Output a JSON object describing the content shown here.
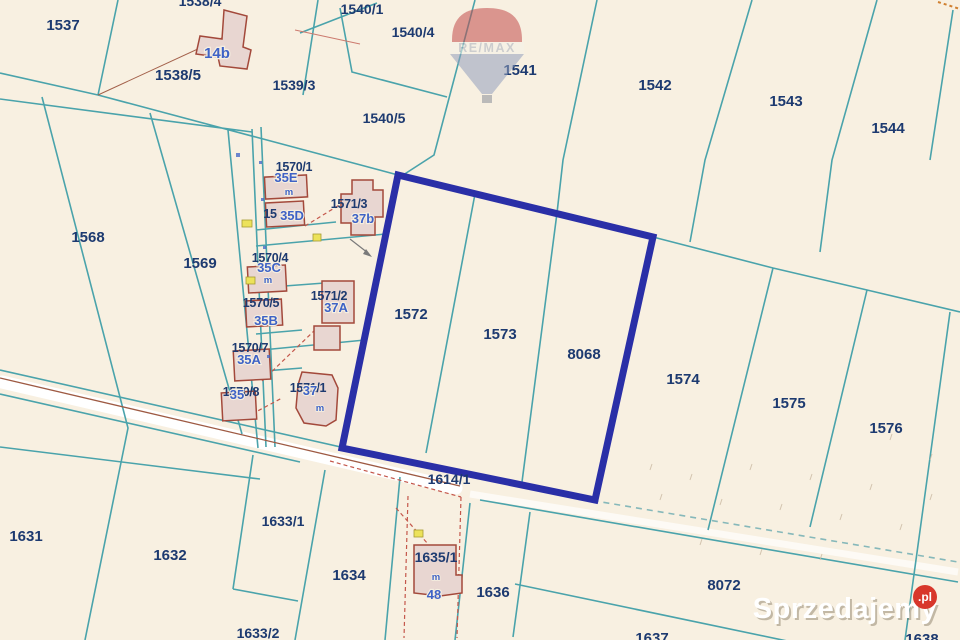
{
  "map": {
    "parcel_labels": {
      "p1537": "1537",
      "p1538_4": "1538/4",
      "p1538_5": "1538/5",
      "p1539_3": "1539/3",
      "p1540_1": "1540/1",
      "p1540_4": "1540/4",
      "p1540_5": "1540/5",
      "p1541": "1541",
      "p1542": "1542",
      "p1543": "1543",
      "p1544": "1544",
      "p1568": "1568",
      "p1569": "1569",
      "p1570_1": "1570/1",
      "p1570_3_prefix": "15",
      "p1570_4": "1570/4",
      "p1570_5": "1570/5",
      "p1570_7": "1570/7",
      "p1570_8": "1570/8",
      "p1571_1": "1571/1",
      "p1571_2": "1571/2",
      "p1571_3": "1571/3",
      "p1572": "1572",
      "p1573": "1573",
      "p8068": "8068",
      "p1574": "1574",
      "p1575": "1575",
      "p1576": "1576",
      "p1614_1": "1614/1",
      "p1631": "1631",
      "p1632": "1632",
      "p1633_1": "1633/1",
      "p1633_2": "1633/2",
      "p1634": "1634",
      "p1635_1": "1635/1",
      "p1636": "1636",
      "p1637": "1637",
      "p8072": "8072",
      "p1638": "1638"
    },
    "building_labels": {
      "b14b": "14b",
      "b35E": "35E",
      "b35D": "35D",
      "b35C": "35C",
      "b35B": "35B",
      "b35A": "35A",
      "b35": "35",
      "b37b": "37b",
      "b37A": "37A",
      "b37": "37",
      "b48": "48",
      "m": "m"
    },
    "highlighted_parcels": [
      "1572",
      "1573",
      "8068"
    ],
    "colors": {
      "background": "#f8f0e1",
      "boundary_teal": "#4aa3ab",
      "parcel_text_navy": "#1d3a70",
      "building_text_blue": "#3e62c6",
      "building_outline": "#a3493b",
      "highlight_navy": "#2a2fa7",
      "road_line_brown": "#9e5a43",
      "watermark_badge_red": "#d8372b"
    }
  },
  "branding": {
    "remax_logo_text": "RE/MAX",
    "watermark_text": "Sprzedajemy",
    "watermark_tld": ".pl"
  }
}
